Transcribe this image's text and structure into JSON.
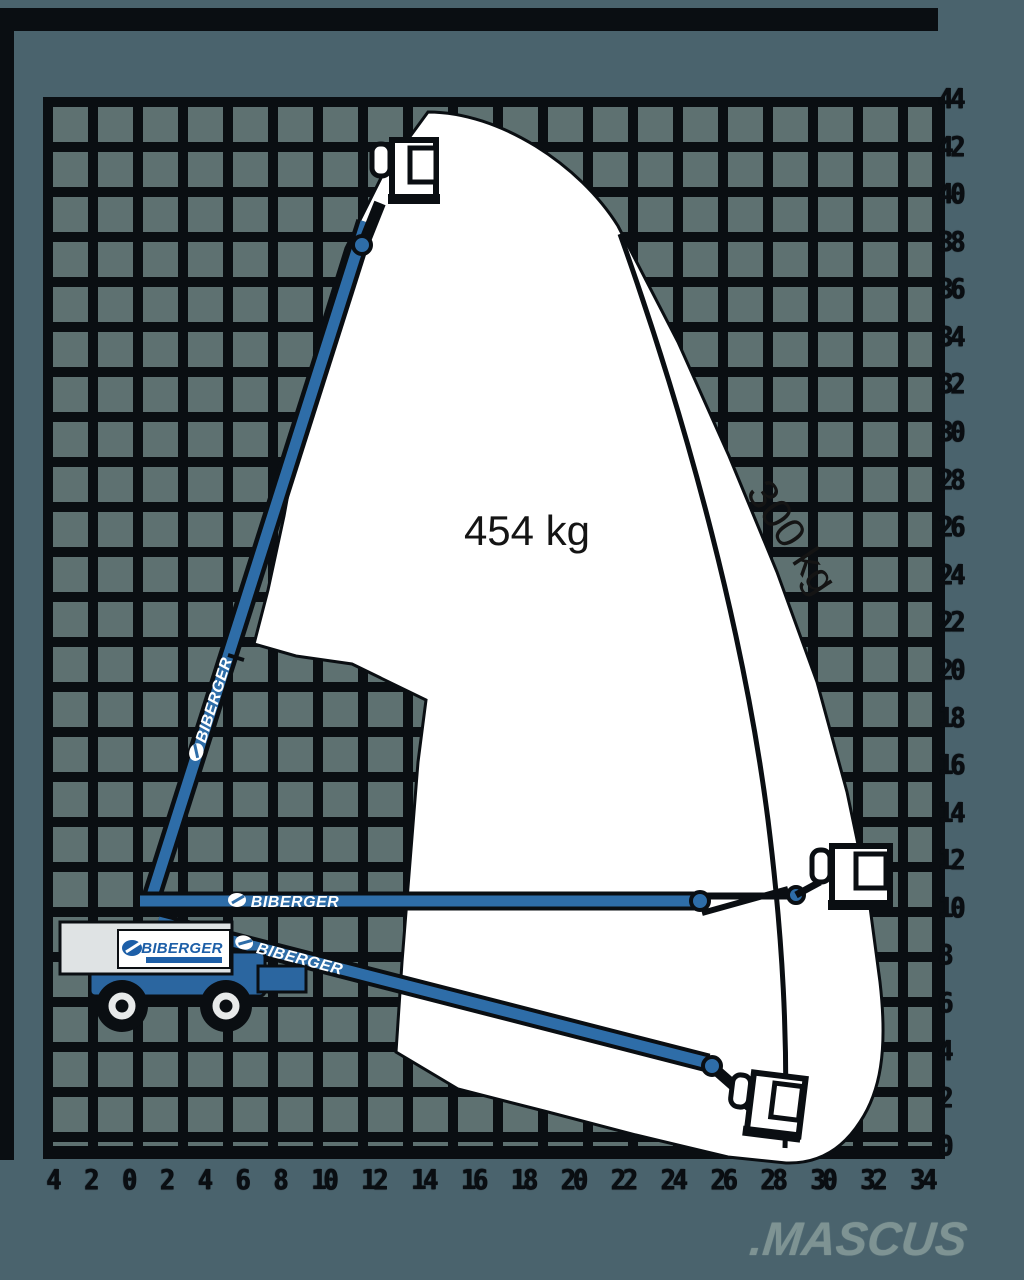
{
  "diagram": {
    "type": "boom-lift-working-envelope",
    "labels": {
      "capacity_inner": "454 kg",
      "capacity_outer": "300 kg"
    },
    "brand_logo": "BIBERGER",
    "watermark": ".MASCUS",
    "colors": {
      "background": "#4a636d",
      "grid_cell": "#5e7171",
      "grid_line": "#0a0e12",
      "envelope_fill": "#ffffff",
      "machine_blue": "#2e6da8",
      "chassis_blue": "#2b66a0",
      "brand_blue": "#1d5fa8",
      "watermark_gray": "#7e9393"
    }
  },
  "axes": {
    "right": {
      "orientation": "vertical",
      "values": [
        "44",
        "42",
        "40",
        "38",
        "36",
        "34",
        "32",
        "30",
        "28",
        "26",
        "24",
        "22",
        "20",
        "18",
        "16",
        "14",
        "12",
        "10",
        "8",
        "6",
        "4",
        "2",
        "0"
      ]
    },
    "bottom": {
      "orientation": "horizontal",
      "values": [
        "4",
        "2",
        "0",
        "2",
        "4",
        "6",
        "8",
        "10",
        "12",
        "14",
        "16",
        "18",
        "20",
        "22",
        "24",
        "26",
        "28",
        "30",
        "32",
        "34"
      ]
    }
  }
}
